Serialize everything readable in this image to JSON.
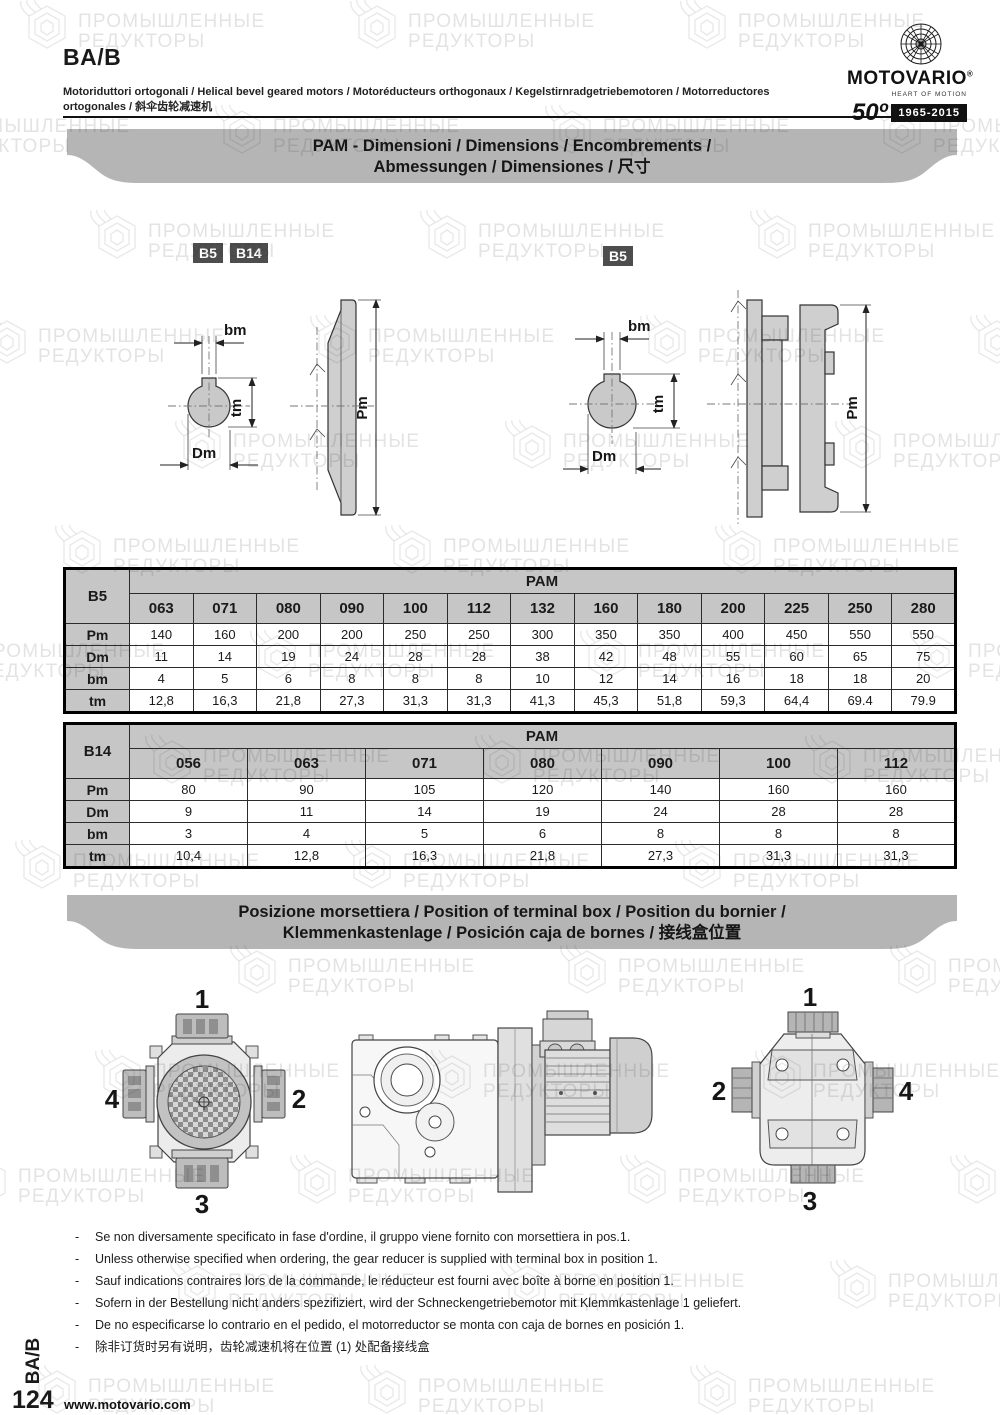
{
  "watermark": {
    "line1": "ПРОМЫШЛЕННЫЕ",
    "line2": "РЕДУКТОРЫ"
  },
  "header": {
    "model": "BA/B",
    "subtitle": "Motoriduttori ortogonali / Helical bevel geared motors / Motoréducteurs orthogonaux / Kegelstirnradgetriebemotoren / Motorreductores ortogonales / 斜伞齿轮减速机",
    "brand": {
      "name": "MOTOVARIO",
      "registered": "®",
      "tagline": "HEART OF MOTION",
      "anniversary_number": "50º",
      "anniversary_years": "1965-2015"
    }
  },
  "banner_pam": {
    "line1": "PAM - Dimensioni / Dimensions / Encombrements /",
    "line2": "Abmessungen / Dimensiones / 尺寸"
  },
  "banner_terminal": {
    "line1": "Posizione morsettiera / Position of terminal box / Position du bornier /",
    "line2": "Klemmenkastenlage / Posición caja de bornes / 接线盒位置"
  },
  "drawings": {
    "flange_left": {
      "badge1": "B5",
      "badge2": "B14",
      "dim_bm": "bm",
      "dim_tm": "tm",
      "dim_dm": "Dm",
      "dim_pm": "Pm"
    },
    "flange_right": {
      "badge1": "B5",
      "dim_bm": "bm",
      "dim_tm": "tm",
      "dim_dm": "Dm",
      "dim_pm": "Pm"
    },
    "terminal_front": {
      "pos_top": "1",
      "pos_right": "2",
      "pos_bottom": "3",
      "pos_left": "4"
    },
    "terminal_rear": {
      "pos_top": "1",
      "pos_left": "2",
      "pos_bottom": "3",
      "pos_right": "4"
    }
  },
  "tables": {
    "b5": {
      "corner": "B5",
      "group": "PAM",
      "columns": [
        "063",
        "071",
        "080",
        "090",
        "100",
        "112",
        "132",
        "160",
        "180",
        "200",
        "225",
        "250",
        "280"
      ],
      "rows": [
        {
          "label": "Pm",
          "values": [
            "140",
            "160",
            "200",
            "200",
            "250",
            "250",
            "300",
            "350",
            "350",
            "400",
            "450",
            "550",
            "550"
          ]
        },
        {
          "label": "Dm",
          "values": [
            "11",
            "14",
            "19",
            "24",
            "28",
            "28",
            "38",
            "42",
            "48",
            "55",
            "60",
            "65",
            "75"
          ]
        },
        {
          "label": "bm",
          "values": [
            "4",
            "5",
            "6",
            "8",
            "8",
            "8",
            "10",
            "12",
            "14",
            "16",
            "18",
            "18",
            "20"
          ]
        },
        {
          "label": "tm",
          "values": [
            "12,8",
            "16,3",
            "21,8",
            "27,3",
            "31,3",
            "31,3",
            "41,3",
            "45,3",
            "51,8",
            "59,3",
            "64,4",
            "69.4",
            "79.9"
          ]
        }
      ]
    },
    "b14": {
      "corner": "B14",
      "group": "PAM",
      "columns": [
        "056",
        "063",
        "071",
        "080",
        "090",
        "100",
        "112"
      ],
      "rows": [
        {
          "label": "Pm",
          "values": [
            "80",
            "90",
            "105",
            "120",
            "140",
            "160",
            "160"
          ]
        },
        {
          "label": "Dm",
          "values": [
            "9",
            "11",
            "14",
            "19",
            "24",
            "28",
            "28"
          ]
        },
        {
          "label": "bm",
          "values": [
            "3",
            "4",
            "5",
            "6",
            "8",
            "8",
            "8"
          ]
        },
        {
          "label": "tm",
          "values": [
            "10,4",
            "12,8",
            "16,3",
            "21,8",
            "27,3",
            "31,3",
            "31,3"
          ]
        }
      ]
    }
  },
  "notes_marker": "-",
  "notes": [
    "Se non diversamente specificato in fase d'ordine, il gruppo viene fornito con morsettiera in pos.1.",
    "Unless otherwise specified when ordering, the gear reducer is supplied with terminal box in position 1.",
    "Sauf indications contraires lors de la commande, le réducteur est fourni avec boîte à borne en position 1.",
    "Sofern in der Bestellung nicht anders spezifiziert, wird der Schneckengetriebemotor mit Klemmkastenlage 1 geliefert.",
    "De no especificarse lo contrario en el pedido, el motorreductor se monta con caja de bornes en posición 1.",
    "除非订货时另有说明，齿轮减速机将在位置 (1) 处配备接线盒"
  ],
  "footer": {
    "side_label": "BA/B",
    "page_number": "124",
    "website": "www.motovario.com"
  }
}
